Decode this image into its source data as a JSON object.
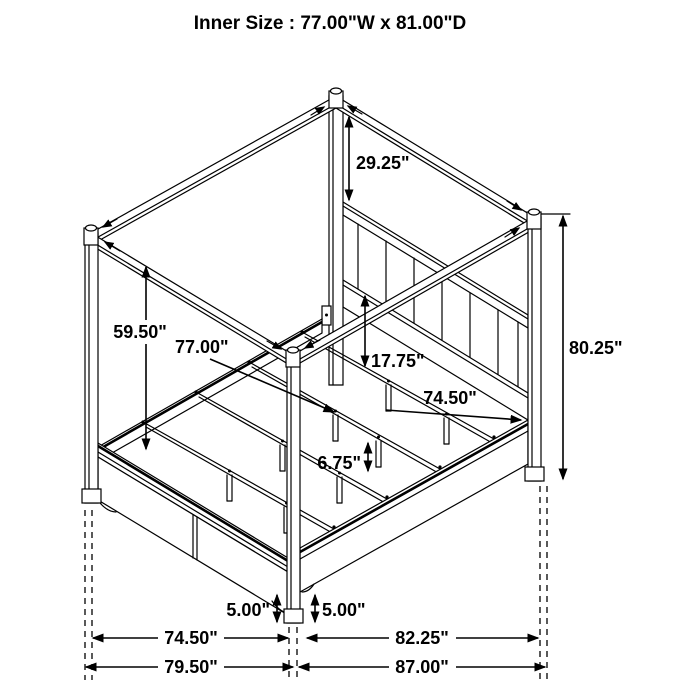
{
  "title": "Inner Size : 77.00\"W x 81.00\"D",
  "diagram": {
    "subject": "canopy-bed-isometric-dimension-drawing",
    "dims": {
      "canopy_to_headboard": "29.25\"",
      "left_post": "59.50\"",
      "slat_width": "77.00\"",
      "headboard_to_deck": "17.75\"",
      "side_rail": "74.50\"",
      "overall_height": "80.25\"",
      "center_leg": "6.75\"",
      "clearance_left": "5.00\"",
      "clearance_right": "5.00\"",
      "width_frame": "74.50\"",
      "width_overall": "79.50\"",
      "depth_frame": "82.25\"",
      "depth_overall": "87.00\""
    }
  }
}
